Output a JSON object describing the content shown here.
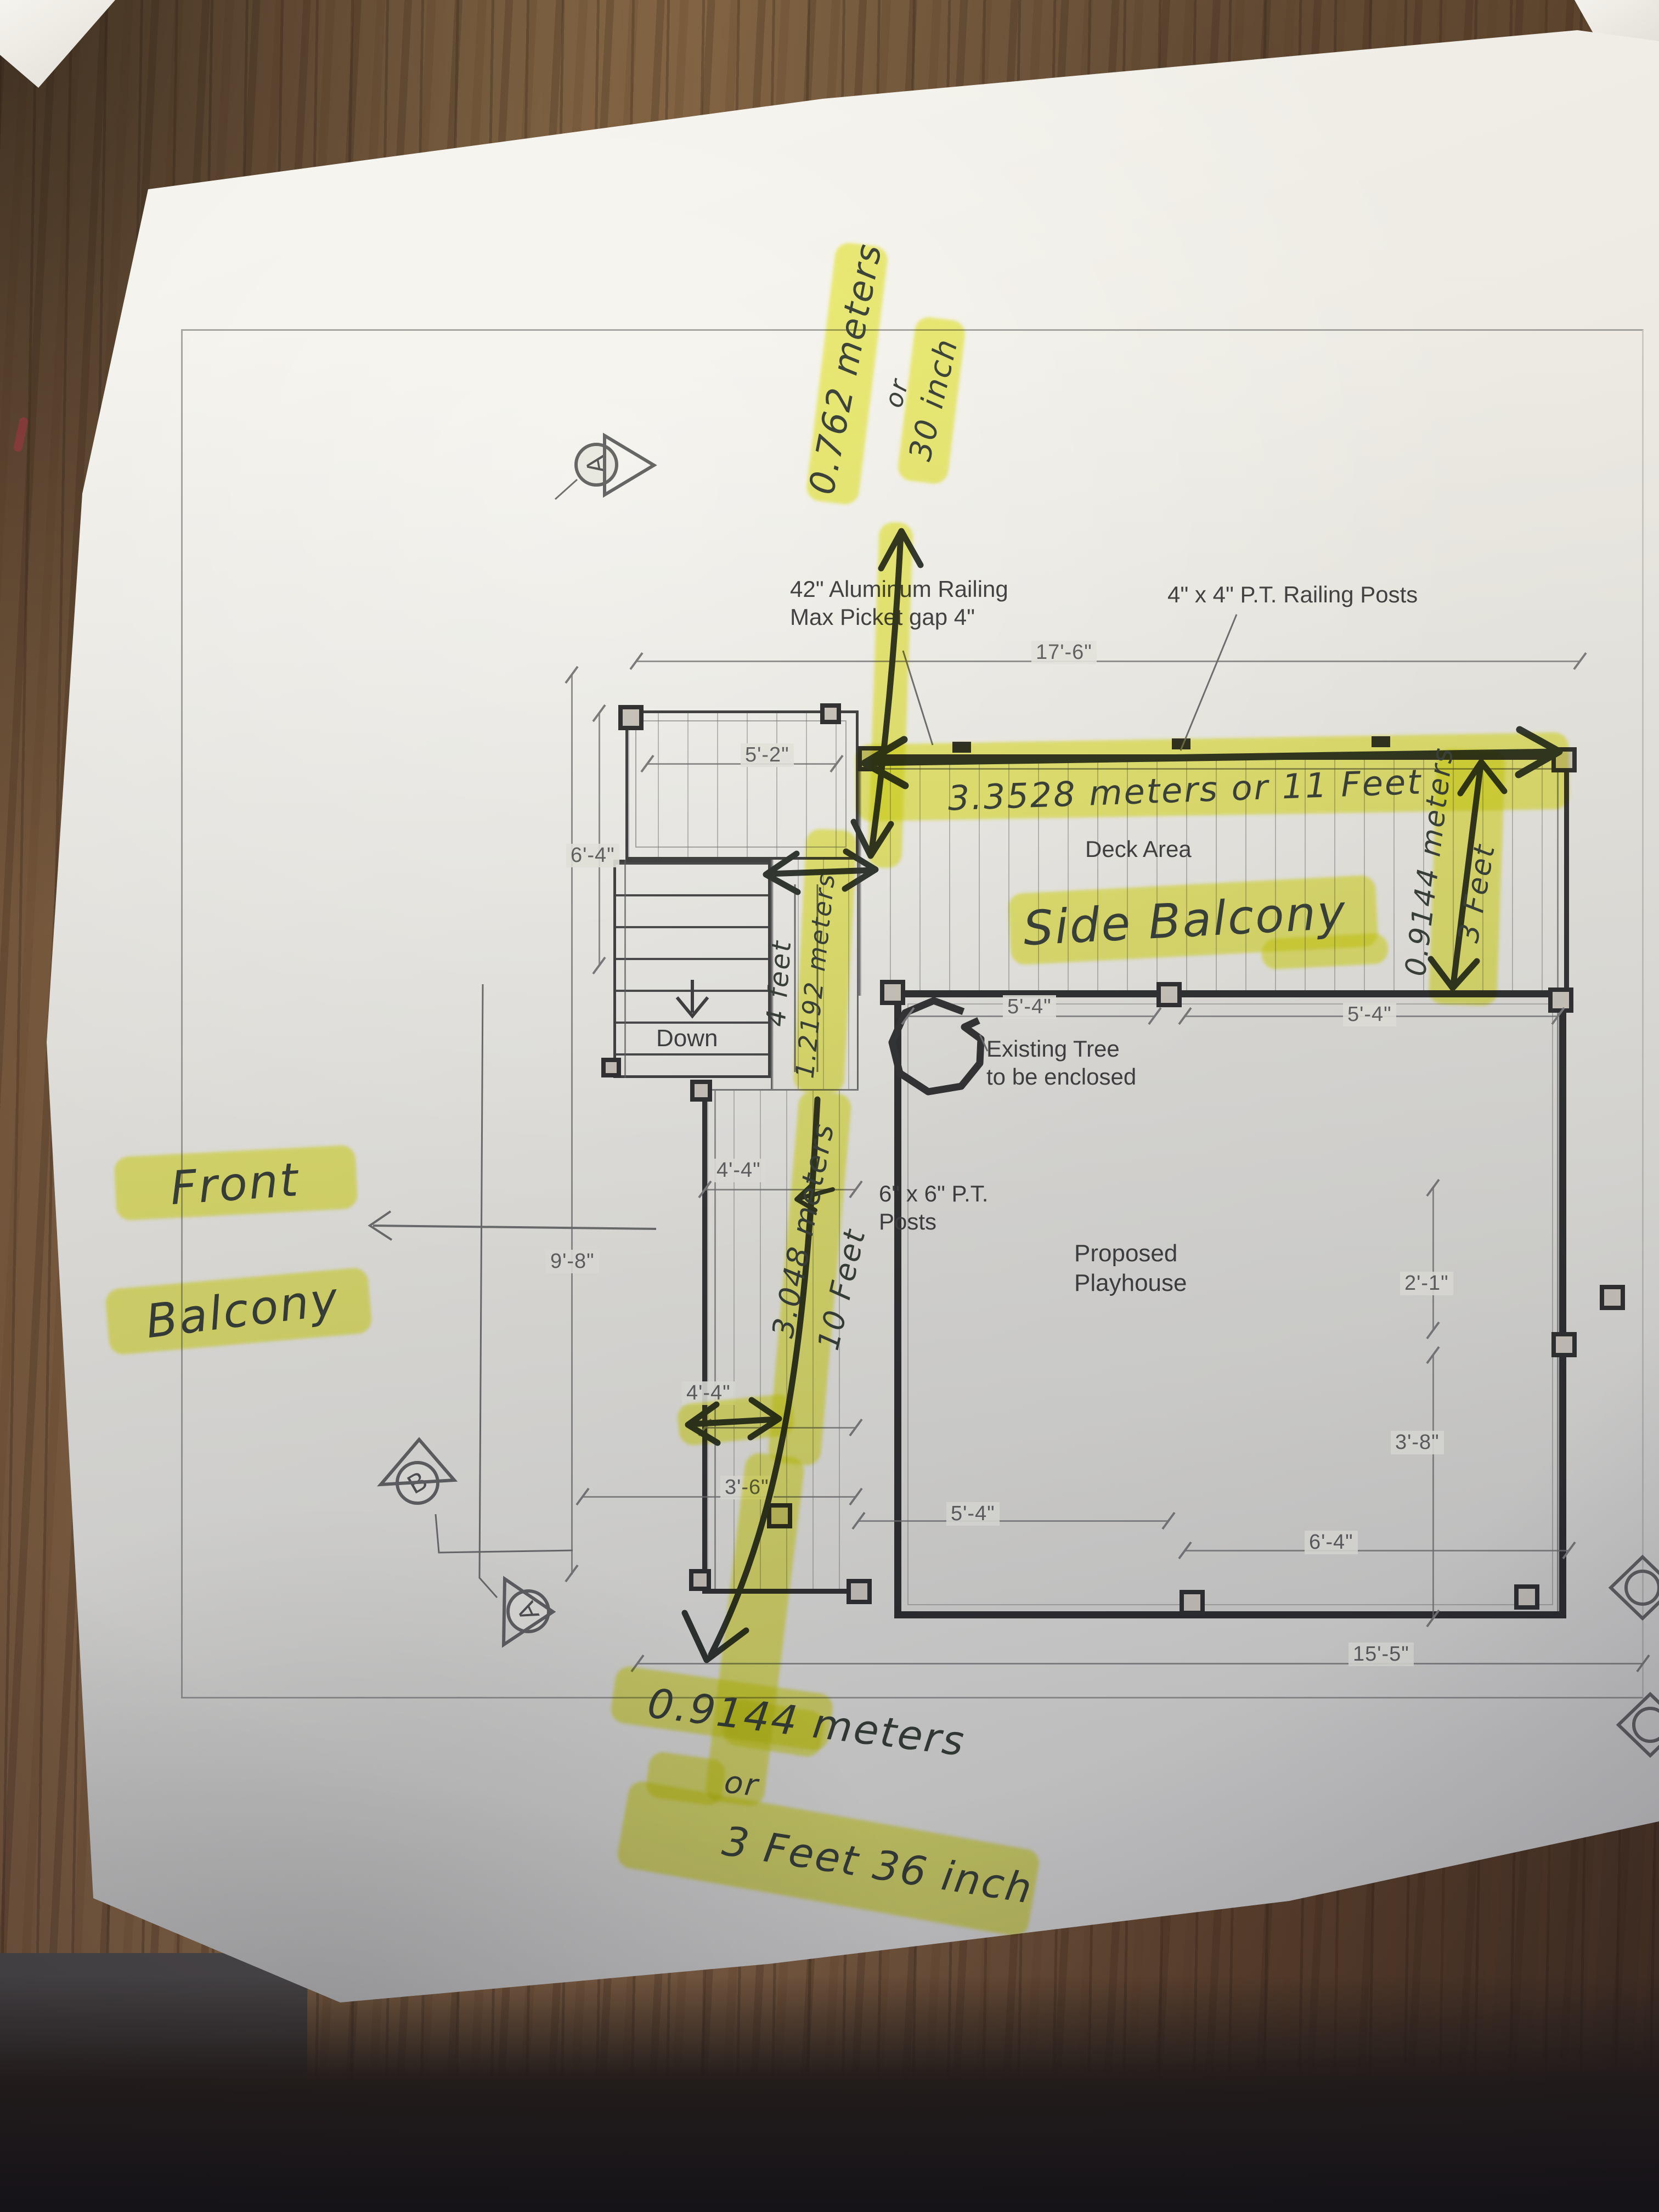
{
  "plan": {
    "printed_notes": {
      "aluminum_railing": [
        "42\" Aluminum Railing",
        "Max Picket gap 4\""
      ],
      "railing_posts": "4\" x 4\" P.T. Railing Posts",
      "deck_area": "Deck Area",
      "stairs_down": "Down",
      "existing_tree": [
        "Existing Tree",
        "to be enclosed"
      ],
      "pt_posts": [
        "6\" x 6\" P.T.",
        "Posts"
      ],
      "proposed_playhouse": [
        "Proposed",
        "Playhouse"
      ]
    },
    "dimensions": {
      "overall_width": "17'-6\"",
      "deck_left_section": "5'-2\"",
      "stairs_side": "6'-4\"",
      "left_side": "9'-8\"",
      "playhouse_top_left": "5'-4\"",
      "playhouse_top_right": "5'-4\"",
      "balcony_width_upper": "4'-4\"",
      "balcony_width_lower": "4'-4\"",
      "walkway_bottom": "3'-6\"",
      "playhouse_bottom_left": "5'-4\"",
      "playhouse_bottom_right": "6'-4\"",
      "right_side_upper": "2'-1\"",
      "right_side_lower": "3'-8\"",
      "overall_bottom": "15'-5\""
    },
    "section_markers": {
      "top": "A",
      "bottom_b": "B",
      "bottom_a": "A"
    }
  },
  "handwritten": {
    "top_railing_gap": {
      "metric": "0.762 meters",
      "conj": "or",
      "imperial": "30 inch"
    },
    "deck_length": "3.3528 meters or 11 Feet",
    "side_balcony": "Side Balcony",
    "deck_depth": {
      "metric": "0.9144 meters",
      "imperial": "3 Feet"
    },
    "landing_width": {
      "imperial": "4 feet",
      "metric": "1.2192 meters"
    },
    "front_balcony_length": {
      "metric": "3.048 meters",
      "imperial": "10 Feet"
    },
    "front_balcony_label": [
      "Front",
      "Balcony"
    ],
    "balcony_width": {
      "metric": "0.9144 meters",
      "conj": "or",
      "imperial": "3 Feet 36 inch"
    }
  },
  "colors": {
    "highlighter": "#eef04e",
    "pen": "#333a31",
    "print": "#3b3b3b",
    "paper": "#e9e7e0",
    "wood": "#7b5b3d"
  }
}
